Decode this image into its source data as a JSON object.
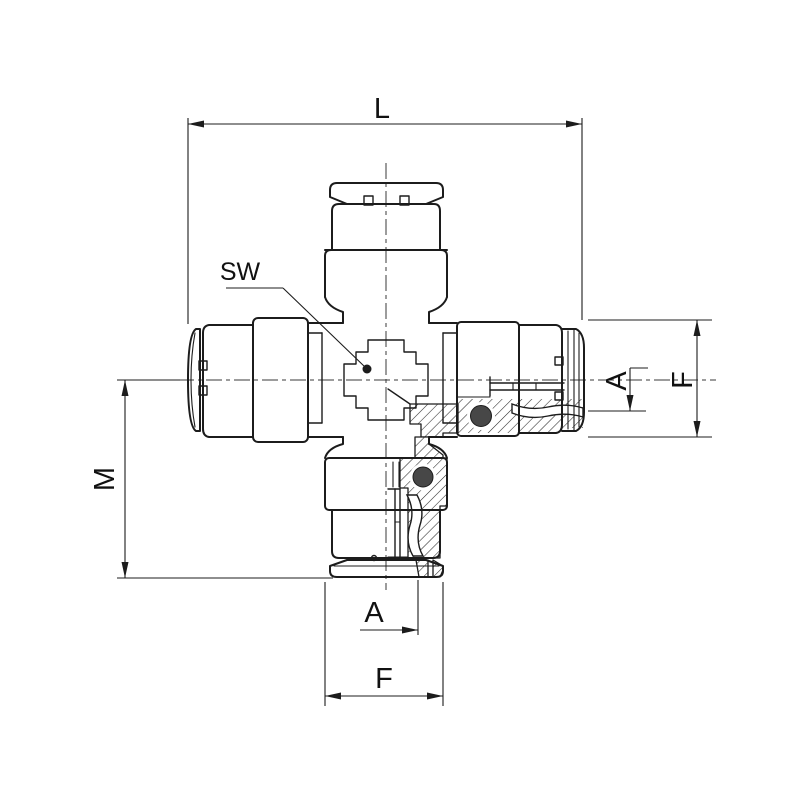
{
  "meta": {
    "description": "Technical engineering line drawing of a pneumatic push-in cross union fitting shown in half-section with dimension annotations",
    "background_color": "#ffffff",
    "line_color": "#1c1c1c",
    "hatch_style": "45-degree section hatching",
    "view": "front view, lower-right quadrant in cross-section"
  },
  "labels": {
    "length_overall": "L",
    "wrench_size": "SW",
    "center_height": "M",
    "offset_right": "A",
    "outer_diameter_right": "F",
    "offset_bottom": "A",
    "outer_diameter_bottom": "F"
  }
}
